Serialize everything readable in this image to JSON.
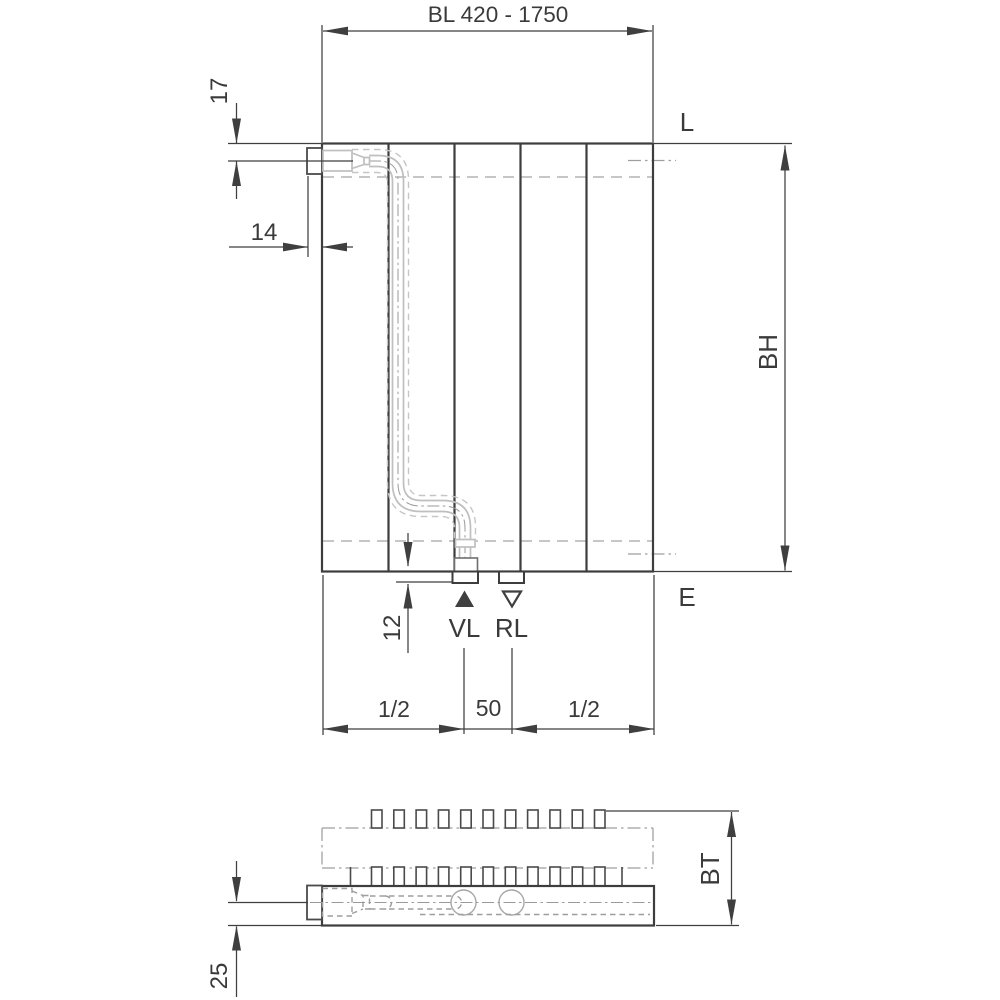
{
  "front_view": {
    "width_dim": "BL 420 - 1750",
    "dim_17": "17",
    "dim_14": "14",
    "label_l": "L",
    "label_bh": "BH",
    "label_e": "E",
    "dim_12": "12",
    "label_vl": "VL",
    "label_rl": "RL",
    "dim_half_left": "1/2",
    "dim_50": "50",
    "dim_half_right": "1/2"
  },
  "bottom_view": {
    "label_bt": "BT",
    "dim_25": "25"
  },
  "colors": {
    "outline": "#3d3d3d",
    "dimension_lines": "#3f3f3f",
    "pipe": "#bfbfbf",
    "hidden_lines": "#9e9e9e",
    "channel_dashed": "#b3b3b3",
    "background": "#ffffff"
  }
}
